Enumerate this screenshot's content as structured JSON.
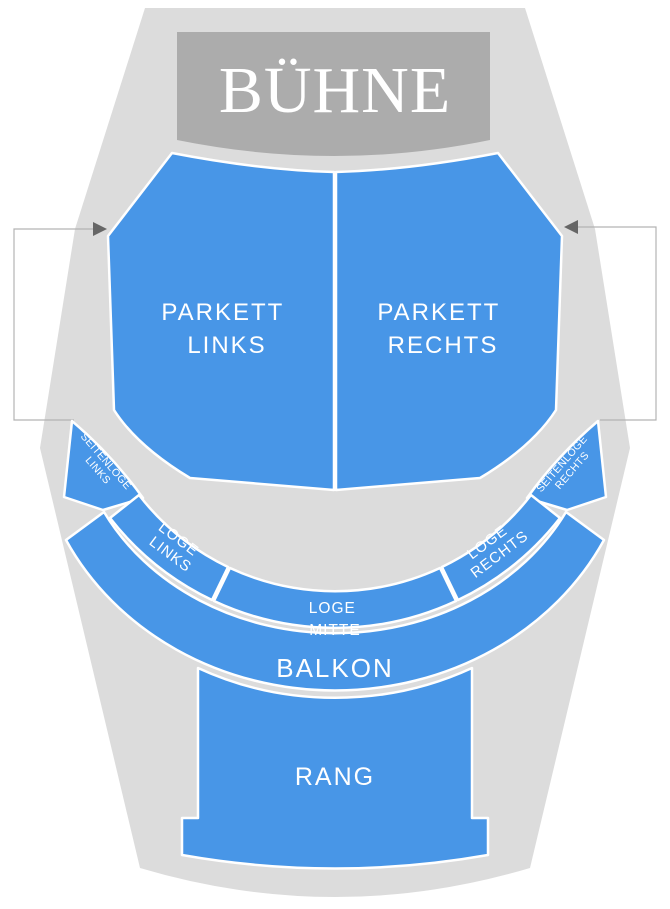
{
  "stage": {
    "label": "BÜHNE"
  },
  "sections": {
    "parkett_links": {
      "line1": "PARKETT",
      "line2": "LINKS"
    },
    "parkett_rechts": {
      "line1": "PARKETT",
      "line2": "RECHTS"
    },
    "seitenloge_links": {
      "line1": "SEITENLOGE",
      "line2": "LINKS"
    },
    "seitenloge_rechts": {
      "line1": "SEITENLOGE",
      "line2": "RECHTS"
    },
    "loge_links": {
      "line1": "LOGE",
      "line2": "LINKS"
    },
    "loge_mitte": {
      "line1": "LOGE",
      "line2": "MITTE"
    },
    "loge_rechts": {
      "line1": "LOGE",
      "line2": "RECHTS"
    },
    "balkon": {
      "label": "BALKON"
    },
    "rang": {
      "label": "RANG"
    }
  },
  "colors": {
    "section_fill": "#4896E7",
    "venue_fill": "#DCDCDC",
    "stage_fill": "#ACACAC",
    "label_color": "#FFFFFF",
    "callout_line": "#B3B3B3",
    "callout_arrow": "#666666",
    "background": "#FFFFFF"
  }
}
